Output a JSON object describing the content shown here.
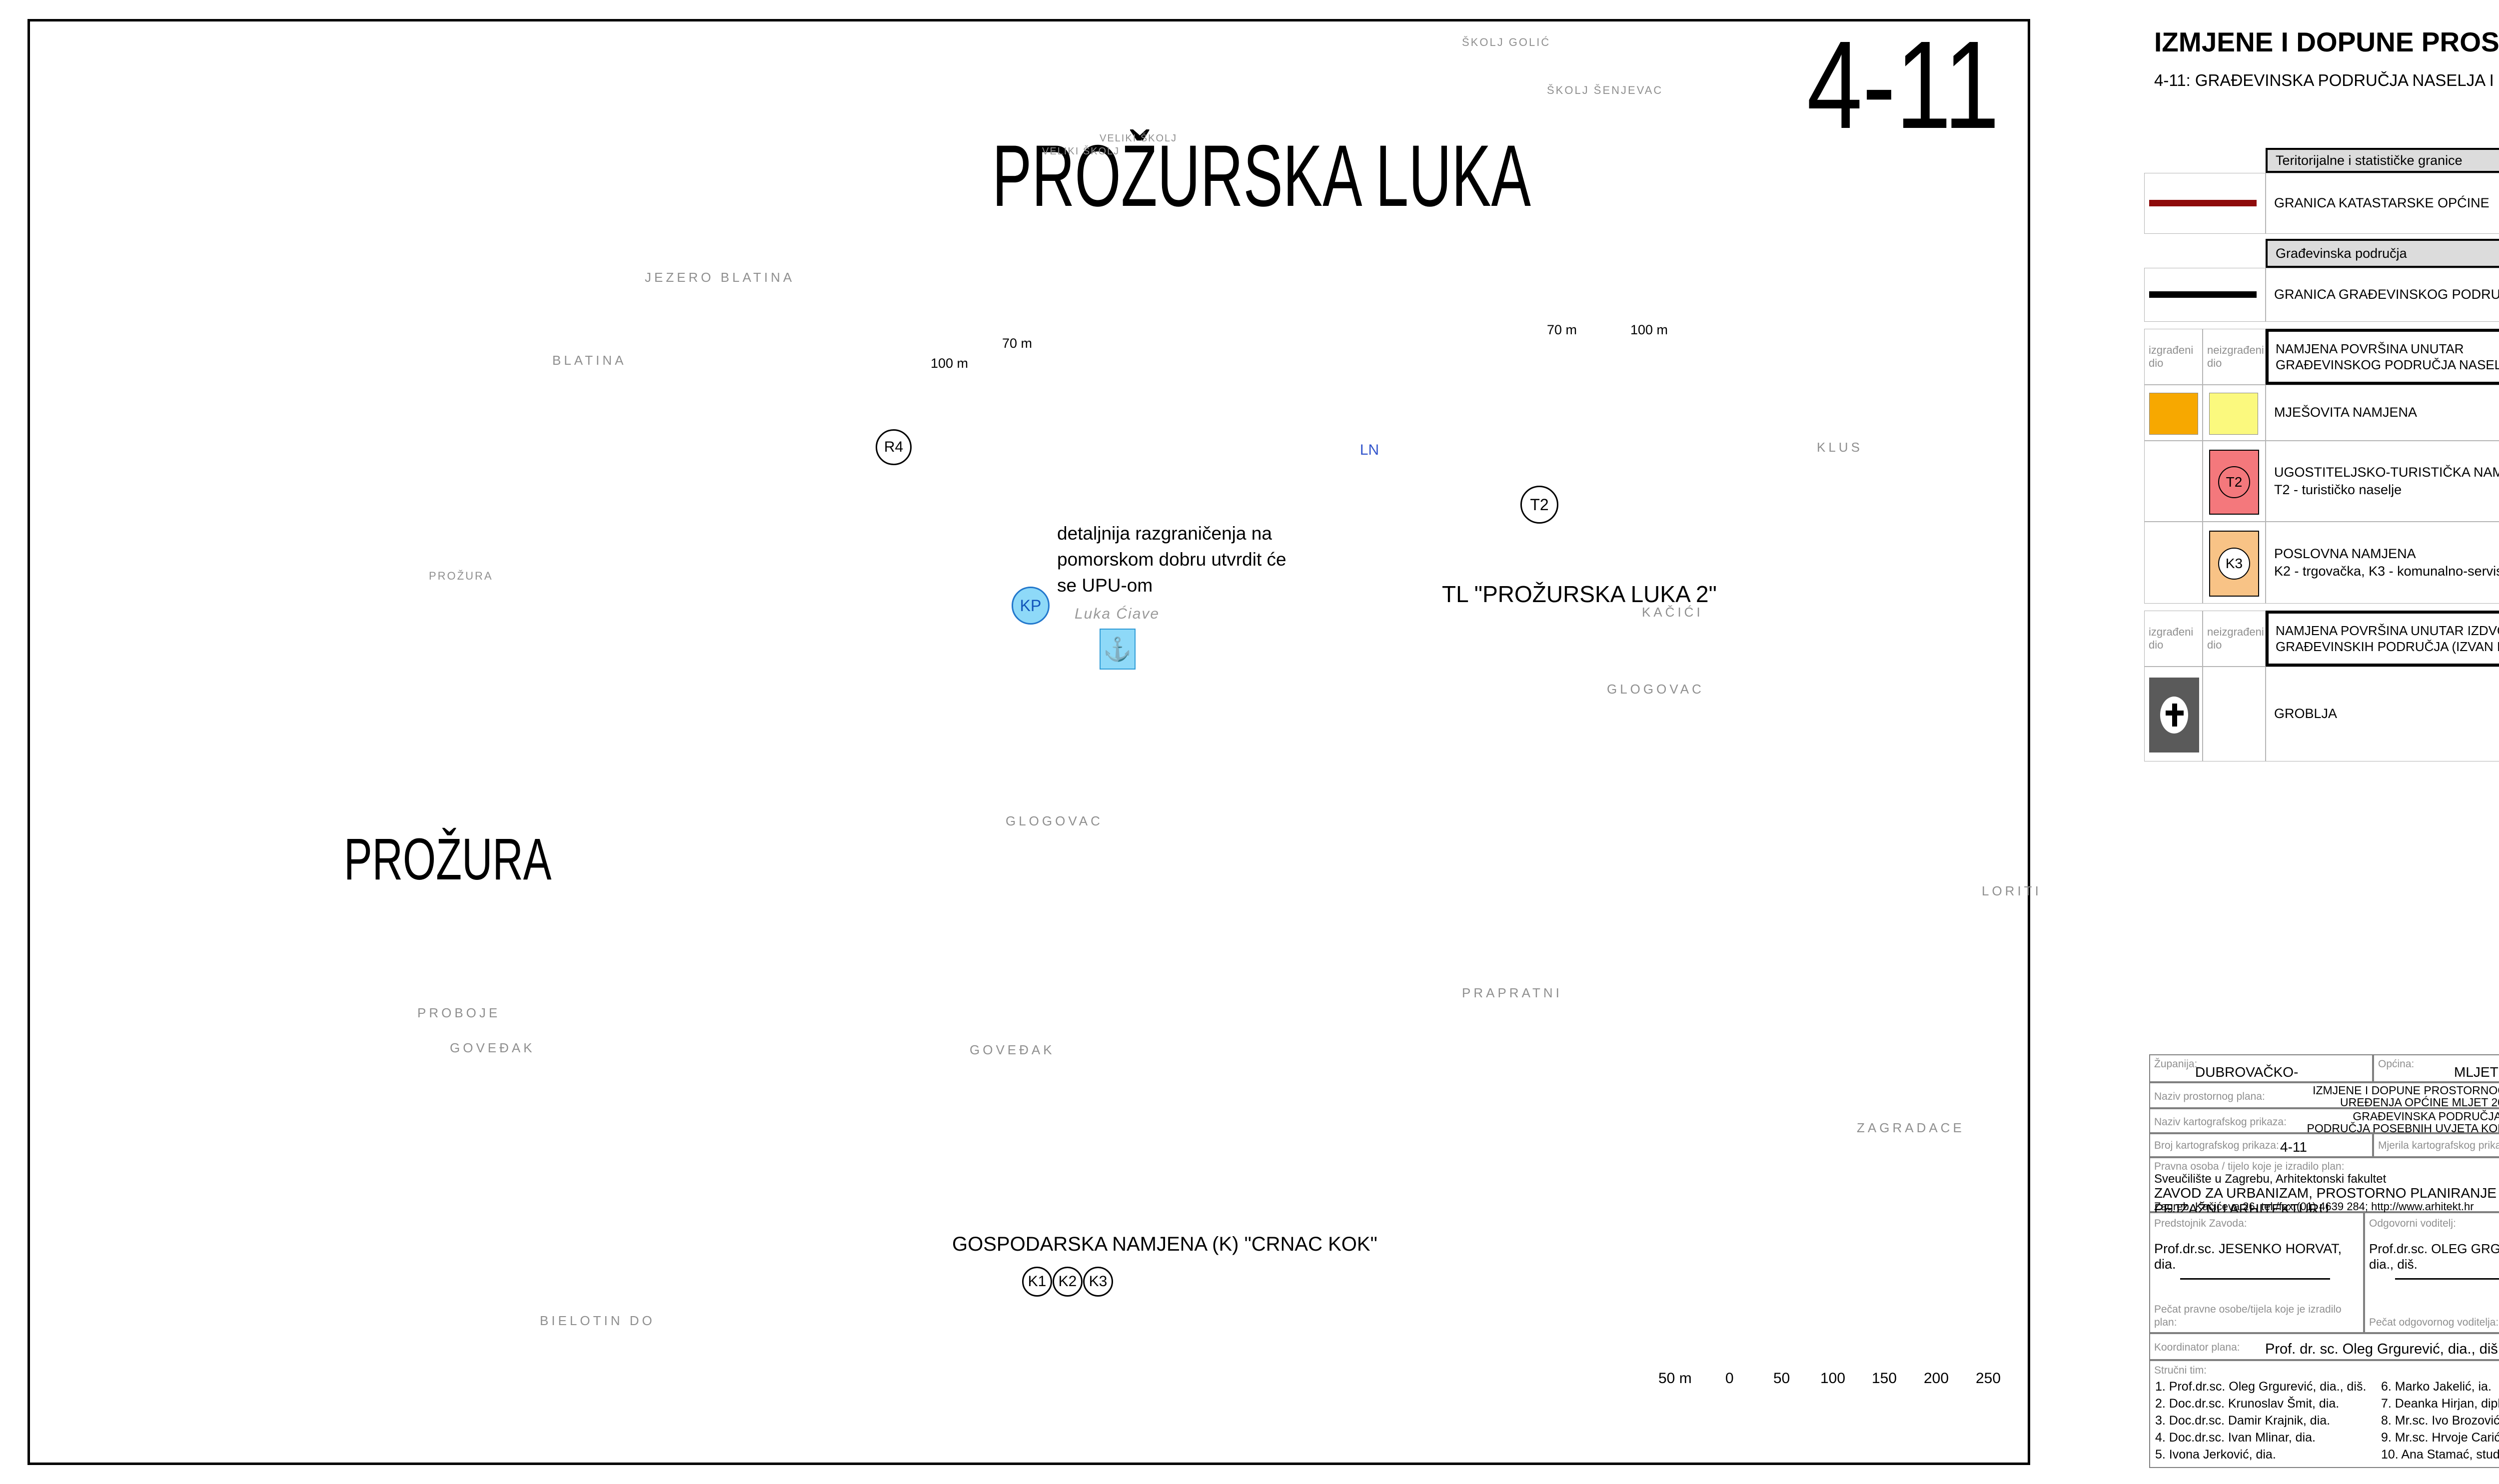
{
  "title_block": {
    "title": "IZMJENE I DOPUNE PROSTORNOG PLANA UREĐENJA OPĆINE MLJET   2010.",
    "subtitle": "4-11: GRAĐEVINSKA PODRUČJA NASELJA I PODRUČJA POSEBNIH UVJETA KORIŠTENJA",
    "scale": "1 : 5 000"
  },
  "map": {
    "sheet_number": "4-11",
    "labels": {
      "prozurska_luka": "PROŽURSKA LUKA",
      "prozura_big": "PROŽURA",
      "prozura_small": "PROŽURA",
      "skolj_golic": "ŠKOLJ GOLIĆ",
      "skolj_senjevac": "ŠKOLJ ŠENJEVAC",
      "veliki_skolj_1": "VELIKI ŠKOLJ",
      "veliki_skolj_2": "VELIKI ŠKOLJ",
      "jezero_blatina": "JEZERO BLATINA",
      "blatina": "BLATINA",
      "glogovac_1": "GLOGOVAC",
      "glogovac_2": "GLOGOVAC",
      "kacici": "KAČIĆI",
      "klus": "KLUS",
      "loriti": "LORITI",
      "prapratni": "PRAPRATNI",
      "zagradace": "ZAGRADACE",
      "govedak_1": "GOVEĐAK",
      "govedak_2": "GOVEĐAK",
      "proboje": "PROBOJE",
      "bielotin_do": "BIELOTIN DO",
      "luka_ciave": "Luka Ćiave",
      "upu_note": "detaljnija razgraničenja na\npomorskom dobru utvrdit će\nse UPU-om",
      "tl_zone": "TL \"PROŽURSKA LUKA 2\"",
      "gospodarska": "GOSPODARSKA NAMJENA (K)  \"CRNAC KOK\"",
      "dist_70_w": "70 m",
      "dist_100_w": "100 m",
      "dist_70_e": "70 m",
      "dist_100_e": "100 m"
    },
    "badges": {
      "r4": "R4",
      "kp": "KP",
      "ln": "LN",
      "t2": "T2",
      "k1": "K1",
      "k2": "K2",
      "k3": "K3"
    },
    "scalebar": {
      "ticks": [
        "50 m",
        "0",
        "50",
        "100",
        "150",
        "200",
        "250"
      ]
    }
  },
  "colors": {
    "mixed_built": "#F7A800",
    "mixed_unbuilt": "#FBF97E",
    "tourist": "#F4787C",
    "business": "#F8C386",
    "cadastral_boundary": "#8E0B0B",
    "coast": "#3434B8",
    "symbol_cyan": "#8ED9F8",
    "zone_red": "#FF0000"
  },
  "legend_left": {
    "header1": "Teritorijalne i statističke granice",
    "item_granica_ko": "GRANICA KATASTARSKE OPĆINE",
    "header2": "Građevinska područja",
    "item_granica_gp": "GRANICA GRAĐEVINSKOG PODRUČJA",
    "col_built": "izgrađeni\ndio",
    "col_unbuilt": "neizgrađeni\ndio",
    "header3": "NAMJENA POVRŠINA UNUTAR\nGRAĐEVINSKOG PODRUČJA NASELJA",
    "item_mjesovita": "MJEŠOVITA NAMJENA",
    "item_turisticka": "UGOSTITELJSKO-TURISTIČKA NAMJENA (\"TL\")\nT2 - turističko naselje",
    "item_poslovna": "POSLOVNA NAMJENA\nK2 - trgovačka, K3 - komunalno-servisna",
    "header4": "NAMJENA POVRŠINA UNUTAR IZDVOJENIH\nGRAĐEVINSKIH PODRUČJA (IZVAN NASELJA)",
    "item_groblja": "GROBLJA",
    "badge_t2": "T2",
    "badge_k3": "K3"
  },
  "legend_right": {
    "col_existing": "postojeće",
    "col_planned": "planirano",
    "header1": "More i zahvati na pomorskom dobru",
    "item_morska_luka": "MORSKA LUKA OTVORENA ZA JAVNI PROMET\nLOKALNOG ZNAČAJA",
    "item_privezisite": "KOMUNALNO PRIVEZIŠTE",
    "item_luka_posebne": "LUKA POSEBNE NAMJENE\nLN - nautički turizam - županijskog značaja *",
    "note": "NAPOMENA: * lokacija je data načelno, točna lokacija\nutvrdit će se analizom kroz UPU",
    "header2": "Područja posebnih uvjeta korištenja",
    "item_zona": "ZONA UŽE ZAŠTITE",
    "item_plaza": "PRIRODNA PLAŽA",
    "item_obuhvat": "OBUHVAT OBVEZNE IZRADE UPU-a",
    "item_obalna": "OBALNA LINIJA\n(PREMA KATASTARSKOJ PODLOZI)",
    "item_linije": "LINIJE 70 I 100 M\nUDALJENE OD OBALNE LINIJE",
    "badge_kp": "KP",
    "badge_ln": "LN",
    "badge_r4": "R4"
  },
  "info_table": {
    "zupanija_label": "Županija:",
    "zupanija": "DUBROVAČKO-NERETVANSKA",
    "opcina_label": "Općina:",
    "opcina": "MLJET",
    "naziv_plana_label": "Naziv prostornog plana:",
    "naziv_plana": "IZMJENE I DOPUNE PROSTORNOG PLANA\nUREĐENJA OPĆINE MLJET 2010.",
    "naziv_prikaza_label": "Naziv kartografskog prikaza:",
    "naziv_prikaza": "GRAĐEVINSKA PODRUČJA I\nPODRUČJA POSEBNIH UVJETA KORIŠTENJA",
    "broj_label": "Broj kartografskog prikaza:",
    "broj": "4-11",
    "mjerila_label": "Mjerila kartografskog prikaza:",
    "mjerila": "1 : 5 000",
    "pravna_label": "Pravna osoba / tijelo koje je izradilo plan:",
    "pravna1": "Sveučilište u Zagrebu, Arhitektonski fakultet",
    "pravna2": "ZAVOD ZA URBANIZAM, PROSTORNO PLANIRANJE I PEJZAŽNU ARHITEKTURU",
    "pravna3": "Zagreb, Kačićeva 26, tel./fax.(01) 4639 284; http://www.arhitekt.hr",
    "predstojnik_label": "Predstojnik Zavoda:",
    "predstojnik": "Prof.dr.sc. JESENKO HORVAT, dia.",
    "voditelj_label": "Odgovorni voditelj:",
    "voditelj": "Prof.dr.sc. OLEG GRGUREVIĆ, dia., diš.",
    "pecat_pravne_label": "Pečat pravne osobe/tijela koje je izradilo plan:",
    "pecat_voditelja_label": "Pečat odgovornog voditelja:",
    "koordinator_label": "Koordinator plana:",
    "koordinator": "Prof. dr. sc. Oleg Grgurević, dia., diš.",
    "tim_label": "Stručni tim:",
    "tim_col1": [
      "1. Prof.dr.sc. Oleg Grgurević, dia., diš.",
      "2. Doc.dr.sc. Krunoslav Šmit, dia.",
      "3. Doc.dr.sc. Damir Krajnik, dia.",
      "4. Doc.dr.sc. Ivan Mlinar, dia.",
      "5. Ivona Jerković, dia."
    ],
    "tim_col2": [
      "6. Marko Jakelić, ia.",
      "7. Deanka Hirjan, dipl.jur.",
      "8. Mr.sc. Ivo Brozović, d.i.prometa",
      "9. Mr.sc. Hrvoje Carić, dipl.oecc.",
      "10. Ana Stamać, stud.arh."
    ],
    "program_label": "Program mjera za unapređenje stanja\nu prostoru (službeno glasilo):",
    "program": "Sl. gl. Općine Mljet\nbr. 01/10",
    "odluka_label": "Odluka predstavničkog tijela o donošenju\nplana (službeno glasilo):",
    "odluka": "Sl. gl. Općine Mljet\nbr. 07/10",
    "rasprava_label": "Javna rasprava - datum objave:",
    "rasprava": "\"Slobodna Dalmacija\" od 16. lipnja 2010.",
    "uvid_label": "Javni uvid održan:",
    "uvid": "od: 25. lipnja 2010.  do: 10. srpnja 2010.",
    "pecat_tijela_label": "Pečat tijela odgovornog za provođenje\njavne rasprave:",
    "osoba_label": "Osoba odgovorna za provođenje\njavne rasprave:",
    "osoba": "Dragec Levak, dipl.iur.",
    "suglasnost1": "Suglasnost na plan prema članku 24. Zakona o prostornom uređenju",
    "suglasnost2": "(\"Narodne novine\", br. 30/94, 68/98, 61/00, 32/02, 100/04.),",
    "broj_suglasnosti_label": "broj suglasnosti: klasa:",
    "klasa": "350-02/10-11/32",
    "urbroj_label": "urbroj:",
    "urbroj": "531-06-10-7",
    "datum_label": "datum:",
    "datum": "21. listopada 2010.",
    "predsjednik_label": "Predsjednik predstavničkog tijela:",
    "predsjednik": "Marina Matana",
    "istovjetnost_label": "Istovjetnost ovog prostornog plana s\nizvornikom ovjerava:",
    "pecat_nadleznog_label": "Pečat nadležnog tijela:"
  }
}
